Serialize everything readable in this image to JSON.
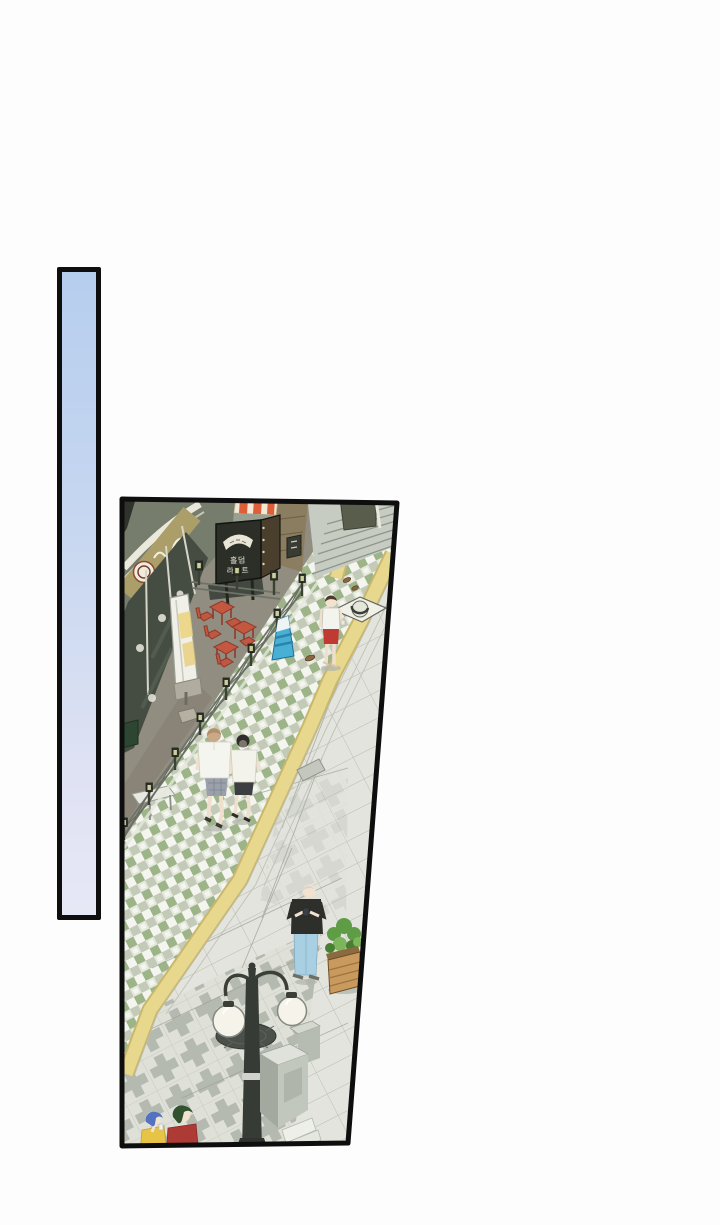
{
  "page": {
    "kind": "webtoon comic page",
    "background_color": "#fdfdfd"
  },
  "panels": {
    "sky_bar": {
      "description": "tall narrow sky panel",
      "border_color": "#0e0e0e",
      "gradient_top": "#b6ceee",
      "gradient_bottom": "#e7e8f6"
    },
    "street_scene": {
      "description": "isometric street scene panel (trapezoid)",
      "border_color": "#0e0e0e"
    }
  },
  "scene": {
    "signboard": {
      "line1": "홀덤",
      "line2": "라이트",
      "board_color": "#2b2f28",
      "text_color": "#e7e6d9"
    },
    "awning": {
      "stripe_color": "#dd5f3a",
      "base_color": "#f1e9d6"
    },
    "storefront": {
      "sign_band_color": "#ac9e69",
      "glass_color": "#454c42"
    },
    "sidewalk": {
      "checker_green": "#9db388",
      "tactile_yellow": "#e8d88e",
      "slab_gray": "#e3e4dd",
      "plus_tile_gray": "#b5bab1"
    },
    "tables_color": "#c4573f",
    "lantern_glow": "#cdd197",
    "street_lamp": {
      "globes": 2,
      "pole_color": "#3a3f38",
      "globe_color": "#f5f3ea"
    },
    "pedestrians": [
      {
        "name": "person-red-shorts",
        "top": "white sleeveless",
        "bottom": "red shorts"
      },
      {
        "name": "walker-brown-hair",
        "top": "white tee",
        "bottom": "plaid shorts"
      },
      {
        "name": "walker-black-hair",
        "top": "white tee",
        "bottom": "black shorts"
      },
      {
        "name": "man-gray-hair",
        "top": "black tee",
        "bottom": "light blue jeans"
      },
      {
        "name": "person-blue-hair",
        "top": "yellow top"
      },
      {
        "name": "person-green-hair",
        "top": "red top"
      }
    ]
  }
}
